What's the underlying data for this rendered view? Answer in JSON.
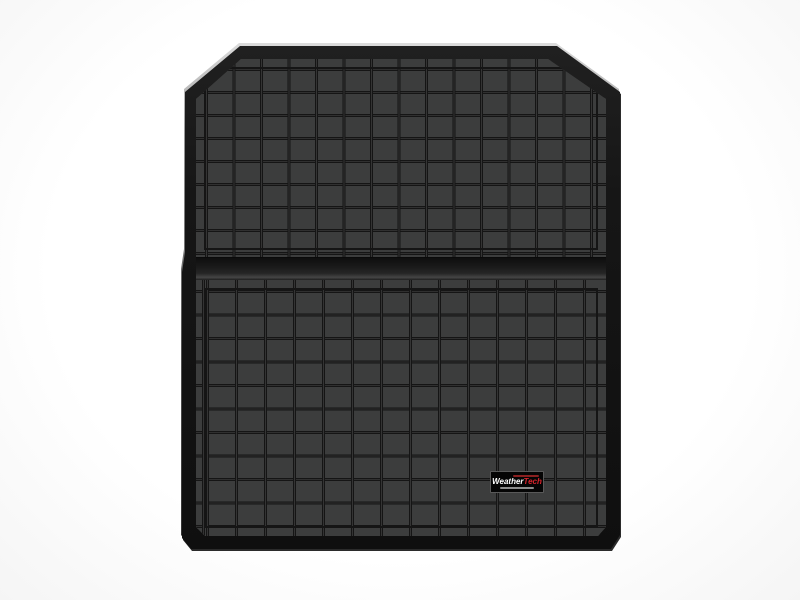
{
  "page": {
    "background_color": "#ffffff"
  },
  "product": {
    "description": "Black molded cargo/trunk liner mat viewed from above, chamfered top corners, raised border rim, waffle grid tread pattern, horizontal fold ridge dividing upper and lower sections",
    "colors": {
      "mat_field": "#3c3d3d",
      "tread_groove": "#151515",
      "rim": "#141414",
      "edge_highlight": "#dcdcdc"
    }
  },
  "logo_badge": {
    "brand_left": "Weather",
    "brand_right": "Tech",
    "brand_left_color": "#ffffff",
    "brand_right_color": "#d8242c",
    "badge_background": "#050505"
  }
}
